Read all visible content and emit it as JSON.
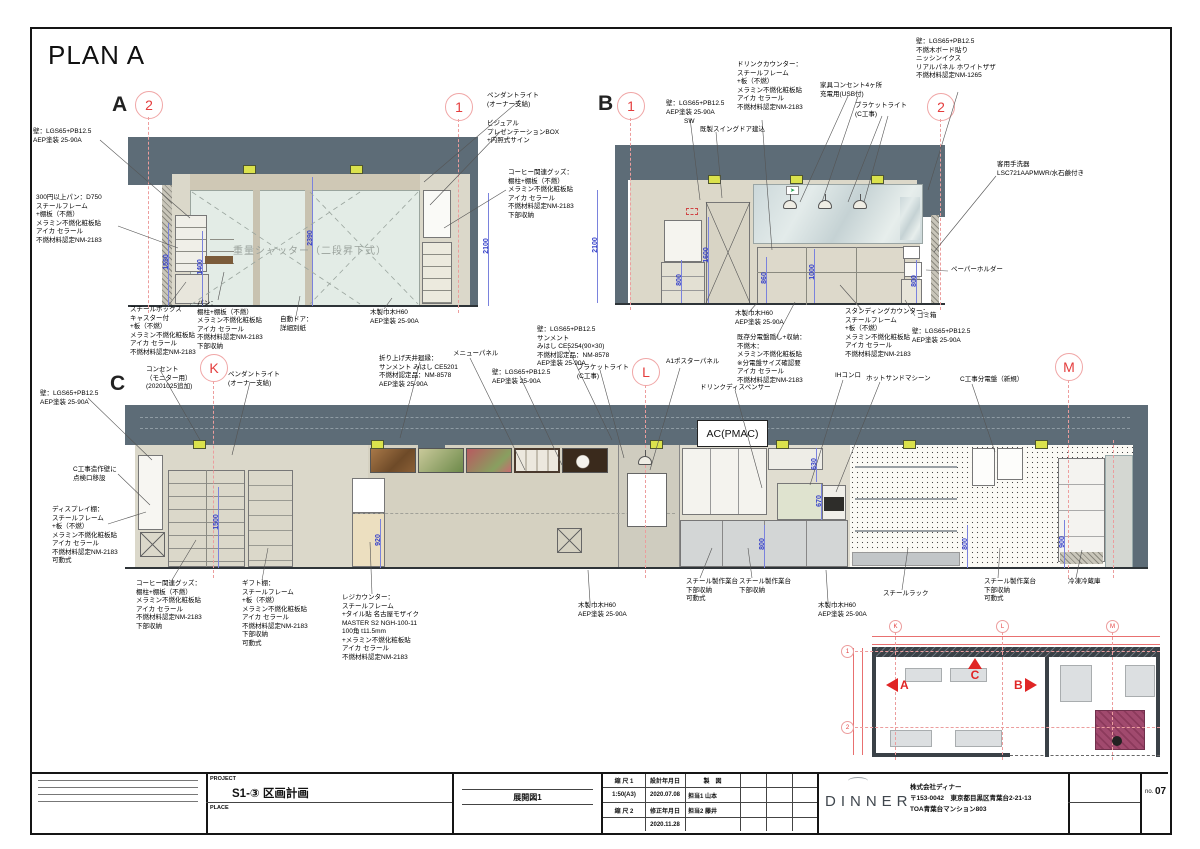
{
  "sheet": {
    "title": "PLAN A"
  },
  "elev_a": {
    "label": "A",
    "grid_markers": [
      "2",
      "1"
    ],
    "shutter_label": "重量シャッター（二段昇下式）",
    "annotations": [
      "壁：LGS65+PB12.5\nAEP塗装 25-90A",
      "300円以上パン：D750\nスチールフレーム\n+棚板（不燃）\nメラミン不燃化粧板貼\nアイカ セラール\n不燃材料認定NM-2183",
      "スチールボックス\nキャスター付\n+板（不燃）\nメラミン不燃化粧板貼\nアイカ セラール\n不燃材料認定NM-2183",
      "パン：\n棚柱+棚板（不燃）\nメラミン不燃化粧板貼\nアイカ セラール\n不燃材料認定NM-2183\n下部収納",
      "自動ドア：\n詳細別紙",
      "木製巾木H60\nAEP塗装 25-90A",
      "ペンダントライト\n(オーナー支給)",
      "ビジュアル\nプレゼンテーションBOX\n+内照式サイン",
      "コーヒー関連グッズ：\n棚柱+棚板（不燃）\nメラミン不燃化粧板貼\nアイカ セラール\n不燃材料認定NM-2183\n下部収納"
    ],
    "dims": [
      "1550",
      "1400",
      "2390",
      "2100"
    ]
  },
  "elev_b": {
    "label": "B",
    "grid_markers": [
      "1",
      "2"
    ],
    "annotations": [
      "壁：LGS65+PB12.5\nAEP塗装 25-90A",
      "SW",
      "既製スイングドア建込",
      "ドリンクカウンター：\nスチールフレーム\n+板（不燃）\nメラミン不燃化粧板貼\nアイカ セラール\n不燃材料認定NM-2183",
      "家具コンセント4ヶ所\n充電用(USB付)",
      "ブラケットライト\n(C工事)",
      "壁：LGS65+PB12.5\n不燃木ボード貼り\nニッシンイクス\nリアルパネル ホワイトザザ\n不燃材料認定NM-1265",
      "客用手洗器\nLSC721AAPMWR/水石鹸付き",
      "ペーパーホルダー",
      "ゴミ箱",
      "壁：LGS65+PB12.5\nAEP塗装 25-90A",
      "木製巾木H60\nAEP塗装 25-90A",
      "スタンディングカウンター：\nスチールフレーム\n+板（不燃）\nメラミン不燃化粧板貼\nアイカ セラール\n不燃材料認定NM-2183",
      "既存分電盤隠し+収納：\n不燃木：\nメラミン不燃化粧板貼\n※分電盤サイズ確認要\nアイカ セラール\n不燃材料認定NM-2183"
    ],
    "dims": [
      "2100",
      "800",
      "1600",
      "860",
      "1000",
      "800"
    ]
  },
  "elev_c": {
    "label": "C",
    "grid_markers": [
      "K",
      "L",
      "M"
    ],
    "ac_label": "AC(PMAC)",
    "annotations": [
      "壁：LGS65+PB12.5\nAEP塗装 25-90A",
      "コンセント\n（モニター用）\n(20201025追加)",
      "ペンダントライト\n(オーナー支給)",
      "C工事造作壁に\n点検口移設",
      "ディスプレイ棚：\nスチールフレーム\n+板（不燃）\nメラミン不燃化粧板貼\nアイカ セラール\n不燃材料認定NM-2183\n可動式",
      "コーヒー関連グッズ：\n棚柱+棚板（不燃）\nメラミン不燃化粧板貼\nアイカ セラール\n不燃材料認定NM-2183\n下部収納",
      "ギフト棚：\nスチールフレーム\n+板（不燃）\nメラミン不燃化粧板貼\nアイカ セラール\n不燃材料認定NM-2183\n下部収納\n可動式",
      "レジカウンター：\nスチールフレーム\n+タイル貼 名古屋モザイク\nMASTER S2 NGH-100-11\n100角 t11.5mm\n+メラミン不燃化粧板貼\nアイカ セラール\n不燃材料認定NM-2183",
      "折り上げ天井廻縁：\nサンメント みはし CE5201\n不燃材認定品：NM-8578\nAEP塗装 25-90A",
      "メニューパネル",
      "壁：LGS65+PB12.5\nAEP塗装 25-90A",
      "壁：LGS65+PB12.5\nサンメント\nみはし CE5254(90×30)\n不燃材認定品：NM-8578\nAEP塗装 25-90A",
      "ブラケットライト\n(C工事)",
      "A1ポスターパネル",
      "ドリンクディスペンサー",
      "IHコンロ",
      "ホットサンドマシーン",
      "C工事分電盤（新規）",
      "スチールラック",
      "スチール製作業台\n下部収納\n可動式",
      "スチール製作業台\n下部収納",
      "木製巾木H60\nAEP塗装 25-90A",
      "木製巾木H60\nAEP塗装 25-90A",
      "スチール製作業台\n下部収納\n可動式",
      "冷凍冷蔵庫"
    ],
    "dims": [
      "1500",
      "920",
      "630",
      "670",
      "800",
      "800",
      "900"
    ]
  },
  "key_plan": {
    "arrows": {
      "a": "A",
      "b": "B",
      "c": "C"
    },
    "grid_top": [
      "K",
      "L",
      "M"
    ],
    "grid_left": [
      "1",
      "2"
    ]
  },
  "title_block": {
    "project_label": "PROJECT",
    "project_name": "S1-③ 区画計画",
    "place_label": "PLACE",
    "drawing_title": "展開図1",
    "scale1_label": "縮 尺 1",
    "scale1_value": "1:50(A3)",
    "scale2_label": "縮 尺 2",
    "design_date_label": "設計年月日",
    "design_date": "2020.07.08",
    "revise_date_label": "修正年月日",
    "revise_date": "2020.11.28",
    "drafting_label": "製　図",
    "staff1": "担当1 山本",
    "staff2": "担当2 藤井",
    "logo": "DINNER",
    "company": "株式会社ディナー",
    "address": "〒153-0042　東京都目黒区青葉台2-21-13",
    "building": "TOA青葉台マンション803",
    "no_label": "no.",
    "sheet_no": "07"
  }
}
